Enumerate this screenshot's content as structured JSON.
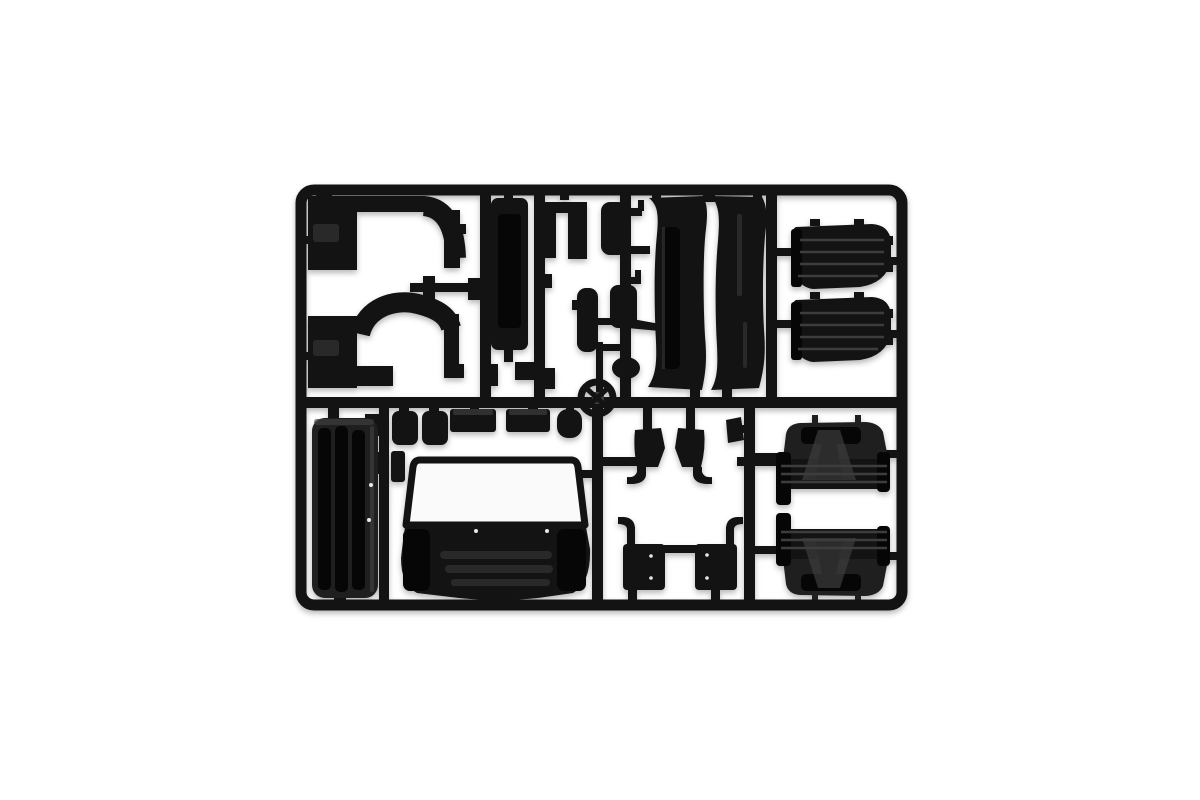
{
  "scene": {
    "title": "Black plastic model-kit sprue with truck cab parts",
    "description": "Product photo of an injection-molded black plastic sprue (parts tree) on a plain white background, containing truck cab model parts: wheel-arch side panels, roof deflector halves, ribbed mudguards, mirrors, a cab front panel with windscreen opening, grille, steps, tanks and a steering wheel."
  },
  "colors": {
    "background": "#ffffff",
    "plastic": "#131313",
    "plastic_mid": "#1f1f1f",
    "plastic_deep": "#060606",
    "plastic_highlight": "#3d3d3d",
    "glass": "#fafafa",
    "ejector_dot": "#e9e9e9"
  },
  "parts": {
    "frame": {
      "label": "Rectangular sprue frame with rounded corners"
    },
    "runners": {
      "label": "Internal sprue runners and gates"
    },
    "cab_side_panel_top": {
      "label": "Cab side panel with wheel arch (upper left)"
    },
    "cab_side_panel_bottom": {
      "label": "Cab side panel with wheel arch (lower left)"
    },
    "door_pillar": {
      "label": "Door pillar trim"
    },
    "bracket": {
      "label": "U-shaped mounting bracket"
    },
    "handle_strip": {
      "label": "Trim strip"
    },
    "small_fittings": {
      "label": "Small fittings"
    },
    "mirror_upper": {
      "label": "Mirror housing (upper)"
    },
    "mirror_lower": {
      "label": "Mirror housing (lower)"
    },
    "round_fitting": {
      "label": "Round fitting"
    },
    "roof_panel_left": {
      "label": "Roof deflector panel, left half"
    },
    "roof_panel_right": {
      "label": "Roof deflector panel, right half"
    },
    "mudguard_top_1": {
      "label": "Ribbed mudguard (upper right, first)"
    },
    "mudguard_top_2": {
      "label": "Ribbed mudguard (upper right, second)"
    },
    "rear_panel": {
      "label": "Cab rear panel with vertical ribs"
    },
    "tank_1": {
      "label": "Small tank"
    },
    "tank_2": {
      "label": "Small tank"
    },
    "tray_1": {
      "label": "Flat tray part"
    },
    "tray_2": {
      "label": "Flat tray part"
    },
    "pot": {
      "label": "Round container part"
    },
    "front_panel": {
      "label": "Cab front panel with windscreen opening"
    },
    "grille": {
      "label": "Front grille with slats"
    },
    "step_bracket_left": {
      "label": "Step bracket with hook (left)"
    },
    "step_bracket_right": {
      "label": "Step bracket with hook (right)"
    },
    "step_panel_left": {
      "label": "Step panel with hook arm (left)"
    },
    "step_panel_right": {
      "label": "Step panel with hook arm (right)"
    },
    "small_bracket": {
      "label": "Small wedge bracket"
    },
    "steering_wheel": {
      "label": "Steering wheel"
    },
    "arch_cover_upper": {
      "label": "Wheel arch cover, ribbed (upper)"
    },
    "arch_cover_lower": {
      "label": "Wheel arch cover, ribbed (lower)"
    }
  }
}
